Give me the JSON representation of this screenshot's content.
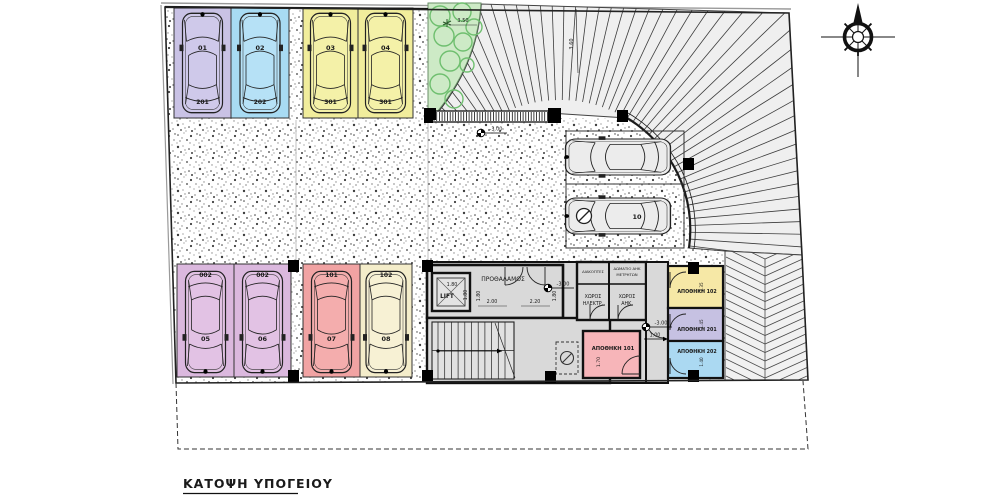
{
  "title": {
    "text": "ΚΑΤΟΨΗ ΥΠΟΓΕΙΟΥ"
  },
  "plan": {
    "labels": {
      "lift": "LIFT",
      "vestibule": "ΠΡΟΘΑΛΑΜΟΣ",
      "breakers": "ΔΙΑΚΟΠΤΕΣ",
      "meter1": "ΔΩΜΑΤΙΟ ΑΗΚ",
      "meter2": "ΜΕΤΡΗΤΩΝ",
      "elec1": "ΧΩΡΟΣ",
      "elec2": "ΗΛΕΚΤΡ.",
      "ahk1": "ΧΩΡΟΣ",
      "ahk2": "ΑΗΚ.",
      "st101": "ΑΠΟΘΗΚΗ 101",
      "st102": "ΑΠΟΘΗΚΗ 102",
      "st201": "ΑΠΟΘΗΚΗ 201",
      "st202": "ΑΠΟΘΗΚΗ 202"
    },
    "levels": {
      "entry": "-3.00",
      "vestibule": "-3.00",
      "corridor": "-3.00"
    },
    "dims": {
      "ramp_w": "3.50",
      "ramp_l": "3.60",
      "lift_w": "1.80",
      "lift_h": "1.80",
      "vest_h1": "1.80",
      "vest_w1": "2.00",
      "vest_w2": "2.20",
      "vest_h2": "1.80",
      "corr": "1.00",
      "st101": "1.70",
      "st102": "1.35",
      "st201": "1.45",
      "st202": "1.40"
    },
    "stalls": {
      "top": [
        {
          "stall": "01",
          "unit": "201",
          "fill": "#c9c2e5",
          "car": "#cfc9ea"
        },
        {
          "stall": "02",
          "unit": "202",
          "fill": "#a8dbf3",
          "car": "#b6e1f6"
        },
        {
          "stall": "03",
          "unit": "301",
          "fill": "#f1ed9c",
          "car": "#f4f1a8"
        },
        {
          "stall": "04",
          "unit": "301",
          "fill": "#f1ed9c",
          "car": "#f4f1a8"
        }
      ],
      "bottom": [
        {
          "stall": "05",
          "unit": "002",
          "fill": "#dbb8de",
          "car": "#e2c2e4"
        },
        {
          "stall": "06",
          "unit": "002",
          "fill": "#dbb8de",
          "car": "#e2c2e4"
        },
        {
          "stall": "07",
          "unit": "101",
          "fill": "#f1a3a3",
          "car": "#f4adad"
        },
        {
          "stall": "08",
          "unit": "102",
          "fill": "#f4edca",
          "car": "#f7f1d4"
        }
      ],
      "aisle": [
        {
          "num": "",
          "accessible": false
        },
        {
          "num": "10",
          "accessible": true
        }
      ]
    },
    "colors": {
      "room_fill": "#d9d9d9",
      "ramp_fill": "#efefef",
      "chevron_fill": "#f1f1f1",
      "green_area": "#cdeac6",
      "tree": "#6fbf6f",
      "wall": "#111111",
      "st101": "#f7b5b9",
      "st102": "#f6e8a6",
      "st201": "#c6c1e2",
      "st202": "#abd9f2",
      "aisle_car": "#ececec"
    }
  }
}
